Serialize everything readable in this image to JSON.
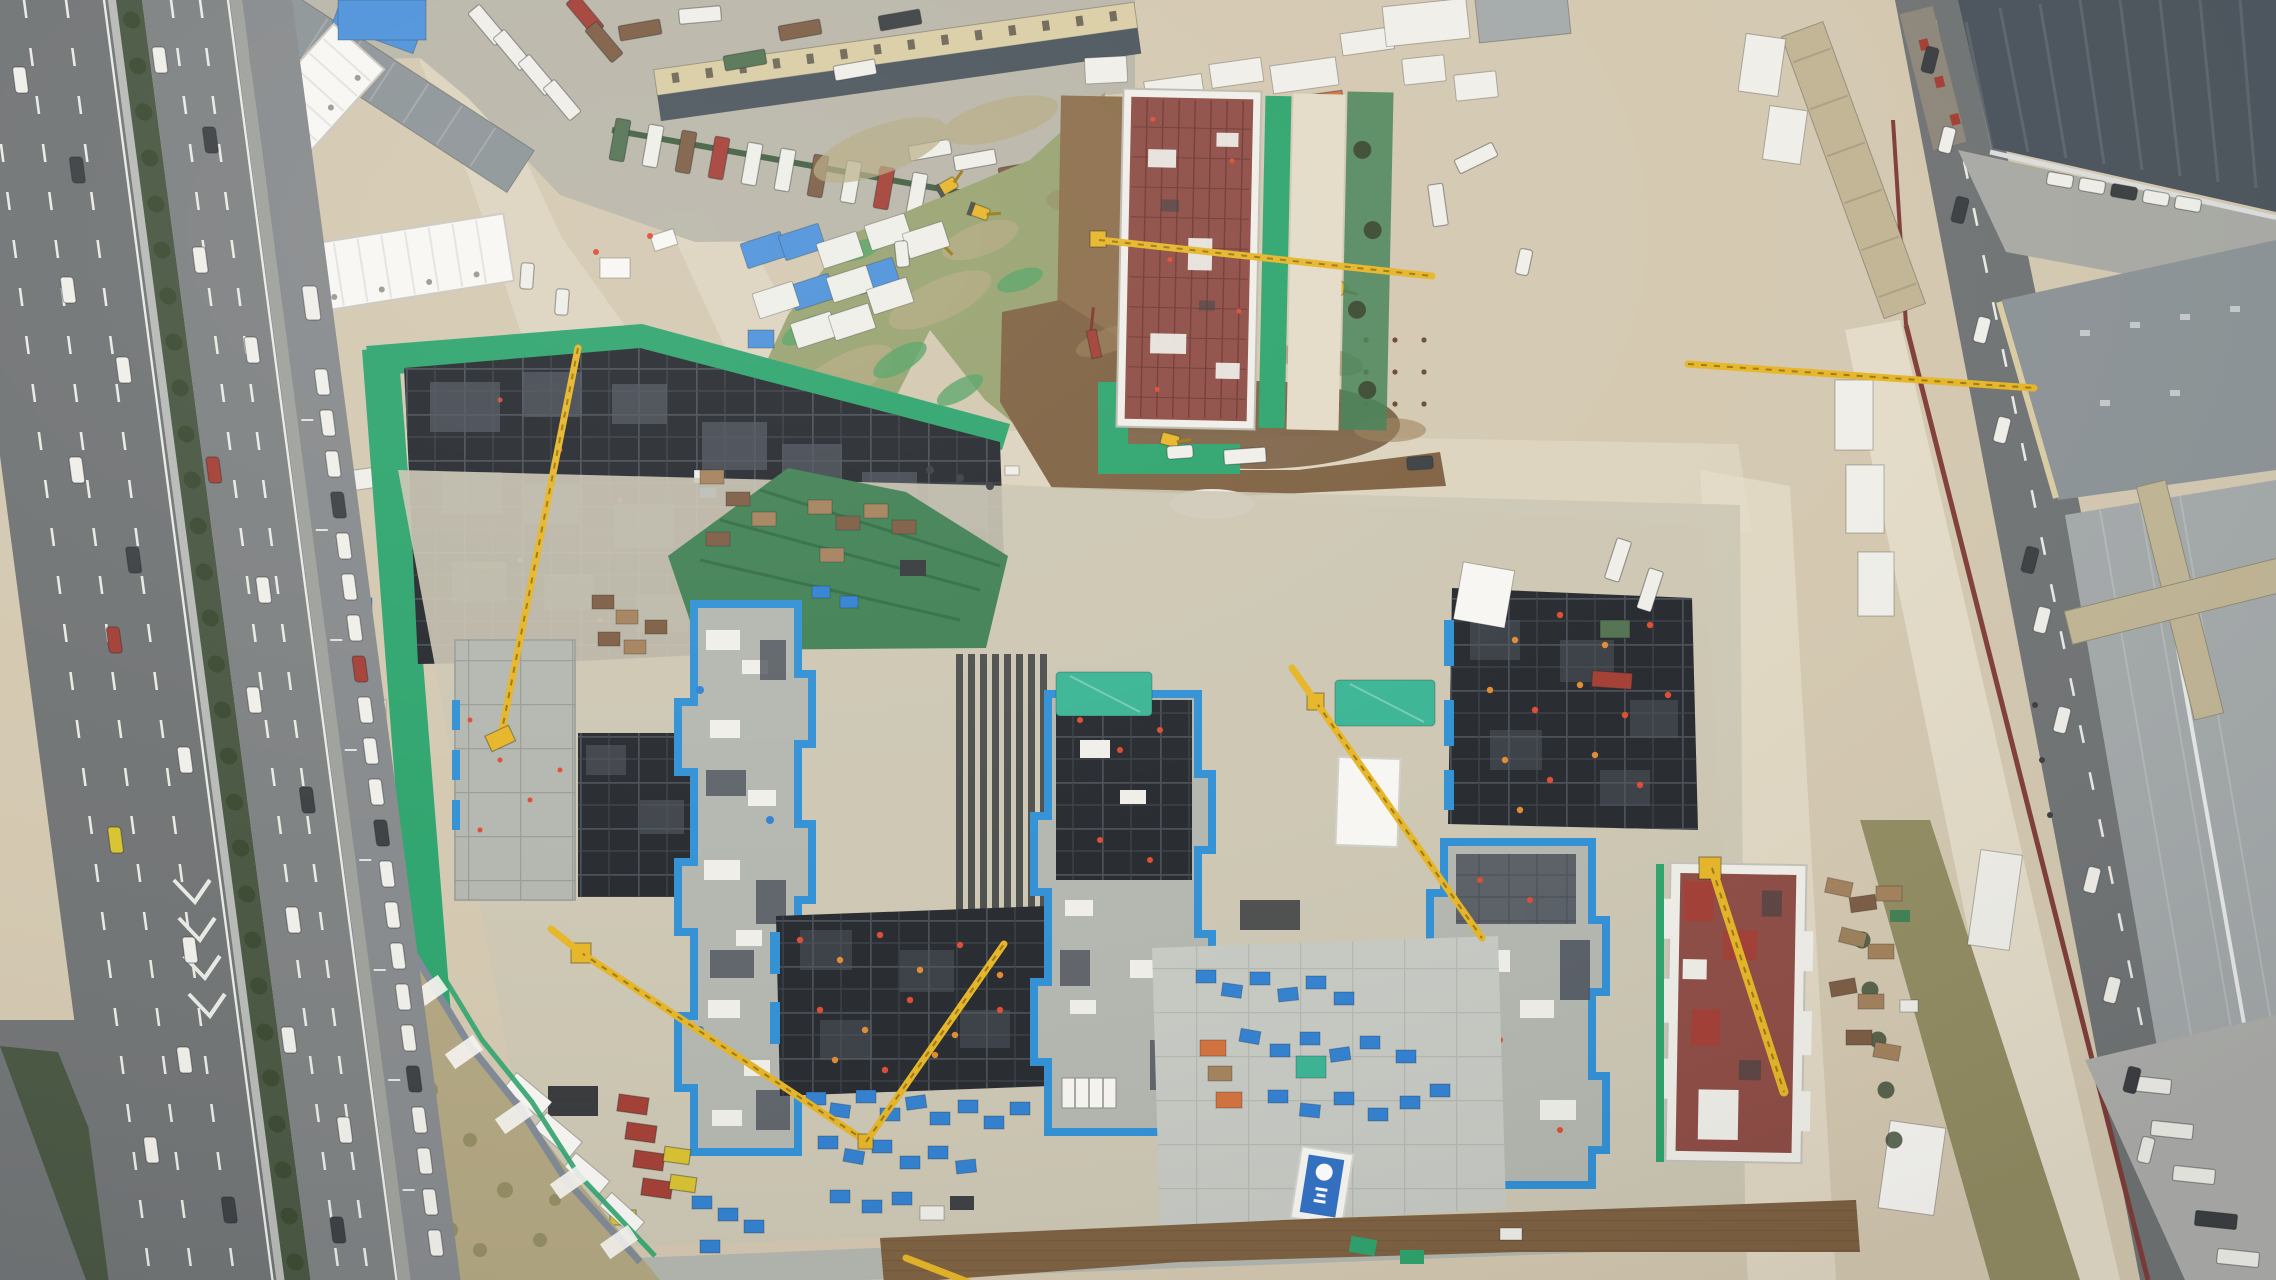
{
  "image": {
    "kind": "aerial-drone-photograph",
    "subject": "Top-down aerial view of a large high-rise construction site with tower cranes, excavation pits, green safety netting and blue edge protection, beside a multi-lane urban expressway",
    "width_px": 2276,
    "height_px": 1280
  },
  "scene_inventory": {
    "tower_crane_booms": 8,
    "excavators": 7,
    "building_footprints_with_blue_edge_protection": 3,
    "black_formwork_decks": 3,
    "red_rebar_structures": 2,
    "white_site_office_blocks": 2,
    "truck_parking_rows": 2,
    "highway_carriageways": 2
  },
  "banner": {
    "shape": "vertical construction-company banner",
    "background": "#2f6fc2",
    "logo": "#ffffff",
    "text_legible": false
  },
  "palette": {
    "ground": "#d3c7af",
    "roadtan": "#dcd3bd",
    "roadtanl": "#e3dbc7",
    "asph": "#6f7273",
    "asphl": "#7c7f80",
    "shldr": "#9d9f9a",
    "front": "#85888a",
    "conc": "#c6c9c2",
    "concd": "#b2b6ae",
    "park": "#b8b4a7",
    "med": "#46543f",
    "tree": "#39472f",
    "hedge": "#3f5c3e",
    "net": "#2ba36b",
    "slope": "#3f7f52",
    "field": "#96a16e",
    "ftan": "#b5a980",
    "fbright": "#55a263",
    "dry": "#b1a57f",
    "brush": "#918b60",
    "dirt": "#7d5f3f",
    "dirtd": "#66482b",
    "dirtl": "#9b7f58",
    "dstrip": "#8a6c48",
    "fw": "#23272c",
    "cell": "#4e545c",
    "bedge": "#2e8fd4",
    "bin": "#2f7fd0",
    "btarp": "#4a90d9",
    "ttarp": "#38b493",
    "yel": "#e6b424",
    "yeld": "#9a7810",
    "ybin": "#d8c22e",
    "redb": "#8c4a42",
    "redd": "#6d352f",
    "maroon": "#7e3b36",
    "wht": "#efeee8",
    "whtb": "#f7f6f2",
    "tred": "#a23c32",
    "tbrn": "#7b5b41",
    "tgrn": "#50704f",
    "torg": "#d2703a",
    "cdark": "#3a3d40",
    "rfd": "#49525a",
    "rfg": "#8b9295",
    "rfl": "#a3a8a9",
    "tanb": "#d9cca3",
    "tanr": "#c0b493",
    "wall": "#7e8894",
    "bann": "#2f6fc2",
    "sred": "#df4930",
    "sorn": "#e08a2e",
    "steel": "#34373a",
    "timb": "#a3805a"
  }
}
